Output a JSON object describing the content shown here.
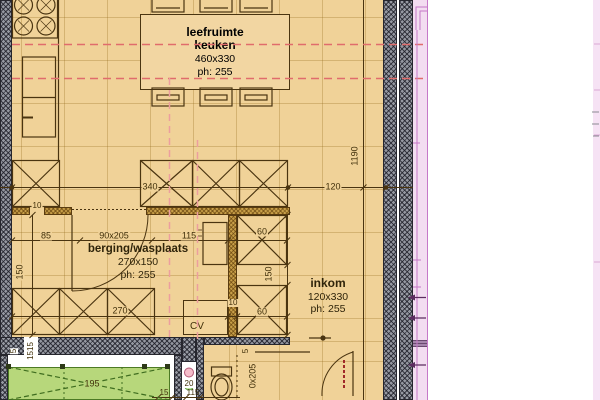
{
  "plan_title": "floor-plan",
  "rooms": {
    "kitchen": {
      "line1": "leefruimte",
      "line2": "keuken",
      "size": "460x330",
      "ph": "ph: 255"
    },
    "storage": {
      "name": "berging/wasplaats",
      "size": "270x150",
      "ph": "ph: 255"
    },
    "entrance": {
      "name": "inkom",
      "size": "120x330",
      "ph": "ph: 255"
    }
  },
  "equipment": {
    "cv": "CV"
  },
  "dims": {
    "w340": "340",
    "w120": "120",
    "h1190": "1190",
    "t10a": "10",
    "w85": "85",
    "door1": "90x205",
    "w115": "115",
    "c60a": "60",
    "c150r": "150",
    "c60b": "60",
    "t10b": "10",
    "h150l": "150",
    "w270": "270",
    "g195": "195",
    "g20": "20",
    "g15": "15",
    "g115": "115",
    "t5a": "5",
    "t1515": "1515",
    "t5b": "5",
    "door2": "0x205"
  },
  "colors": {
    "floor": "#f0d298",
    "wall_gray": "#9598a1",
    "wall_brown": "#c79e48",
    "line": "#4a3410",
    "dash_red": "#e06c6c",
    "dash_pink": "#ec9e9e",
    "green_zone": "#b7d77b",
    "green_line": "#3f6d1f",
    "pink_band": "#f3ddf1",
    "pink_line": "#c678c8",
    "purple_mark": "#5c2c60",
    "pipe_pink": "#f4bcca",
    "pipe_green": "#c2e4a4"
  }
}
